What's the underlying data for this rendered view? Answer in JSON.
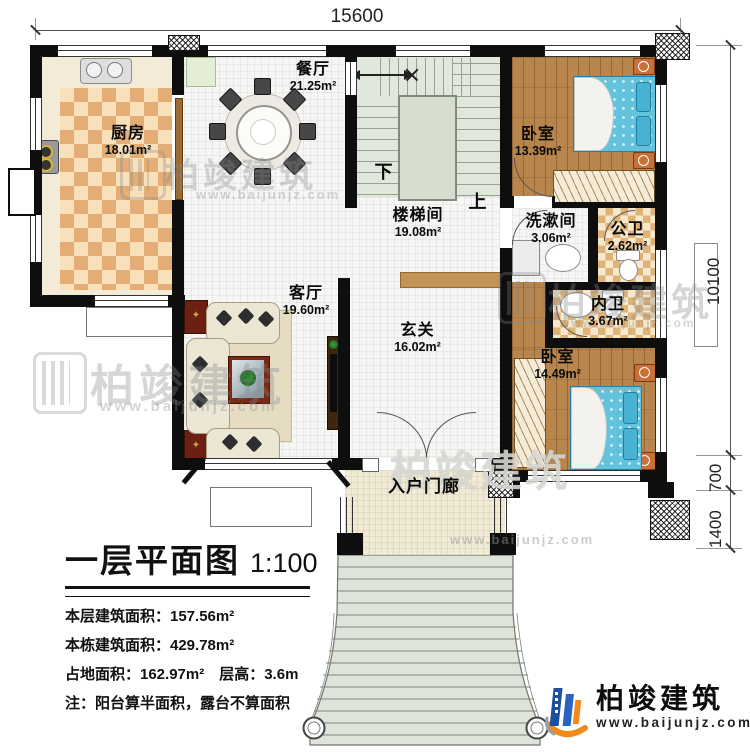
{
  "dimensions": {
    "top": "15600",
    "right_total": "10100",
    "right_upper": "700",
    "right_lower": "1400"
  },
  "rooms": {
    "kitchen": {
      "name": "厨房",
      "area": "18.01m²"
    },
    "dining": {
      "name": "餐厅",
      "area": "21.25m²"
    },
    "stair_hall": {
      "name": "楼梯间",
      "area": "19.08m²"
    },
    "bedroom_top": {
      "name": "卧室",
      "area": "13.39m²"
    },
    "washroom": {
      "name": "洗漱间",
      "area": "3.06m²"
    },
    "public_bath": {
      "name": "公卫",
      "area": "2.62m²"
    },
    "inner_bath": {
      "name": "内卫",
      "area": "3.67m²"
    },
    "living": {
      "name": "客厅",
      "area": "19.60m²"
    },
    "foyer": {
      "name": "玄关",
      "area": "16.02m²"
    },
    "bedroom_bottom": {
      "name": "卧室",
      "area": "14.49m²"
    },
    "porch": {
      "name": "入户门廊"
    }
  },
  "stair_marks": {
    "down": "下",
    "up": "上"
  },
  "title_block": {
    "title": "一层平面图",
    "scale": "1:100",
    "info_lines": [
      "本层建筑面积：157.56m²",
      "本栋建筑面积：429.78m²",
      "占地面积：162.97m²　层高：3.6m",
      "注：阳台算半面积，露台不算面积"
    ]
  },
  "logo": {
    "company": "柏竣建筑",
    "website": "www.baijunjz.com"
  },
  "watermark": {
    "company": "柏竣建筑",
    "website": "www.baijunjz.com"
  },
  "colors": {
    "wall": "#0e0e0e",
    "kitchen_checker": "#e3ad75",
    "wood_floor": "#b8854c",
    "bed_blue": "#63c3dc",
    "stair_green": "#e0e7db",
    "porch_tile": "#f1ead5",
    "logo_blue": "#1f4fa0",
    "logo_orange": "#f08a1c"
  }
}
